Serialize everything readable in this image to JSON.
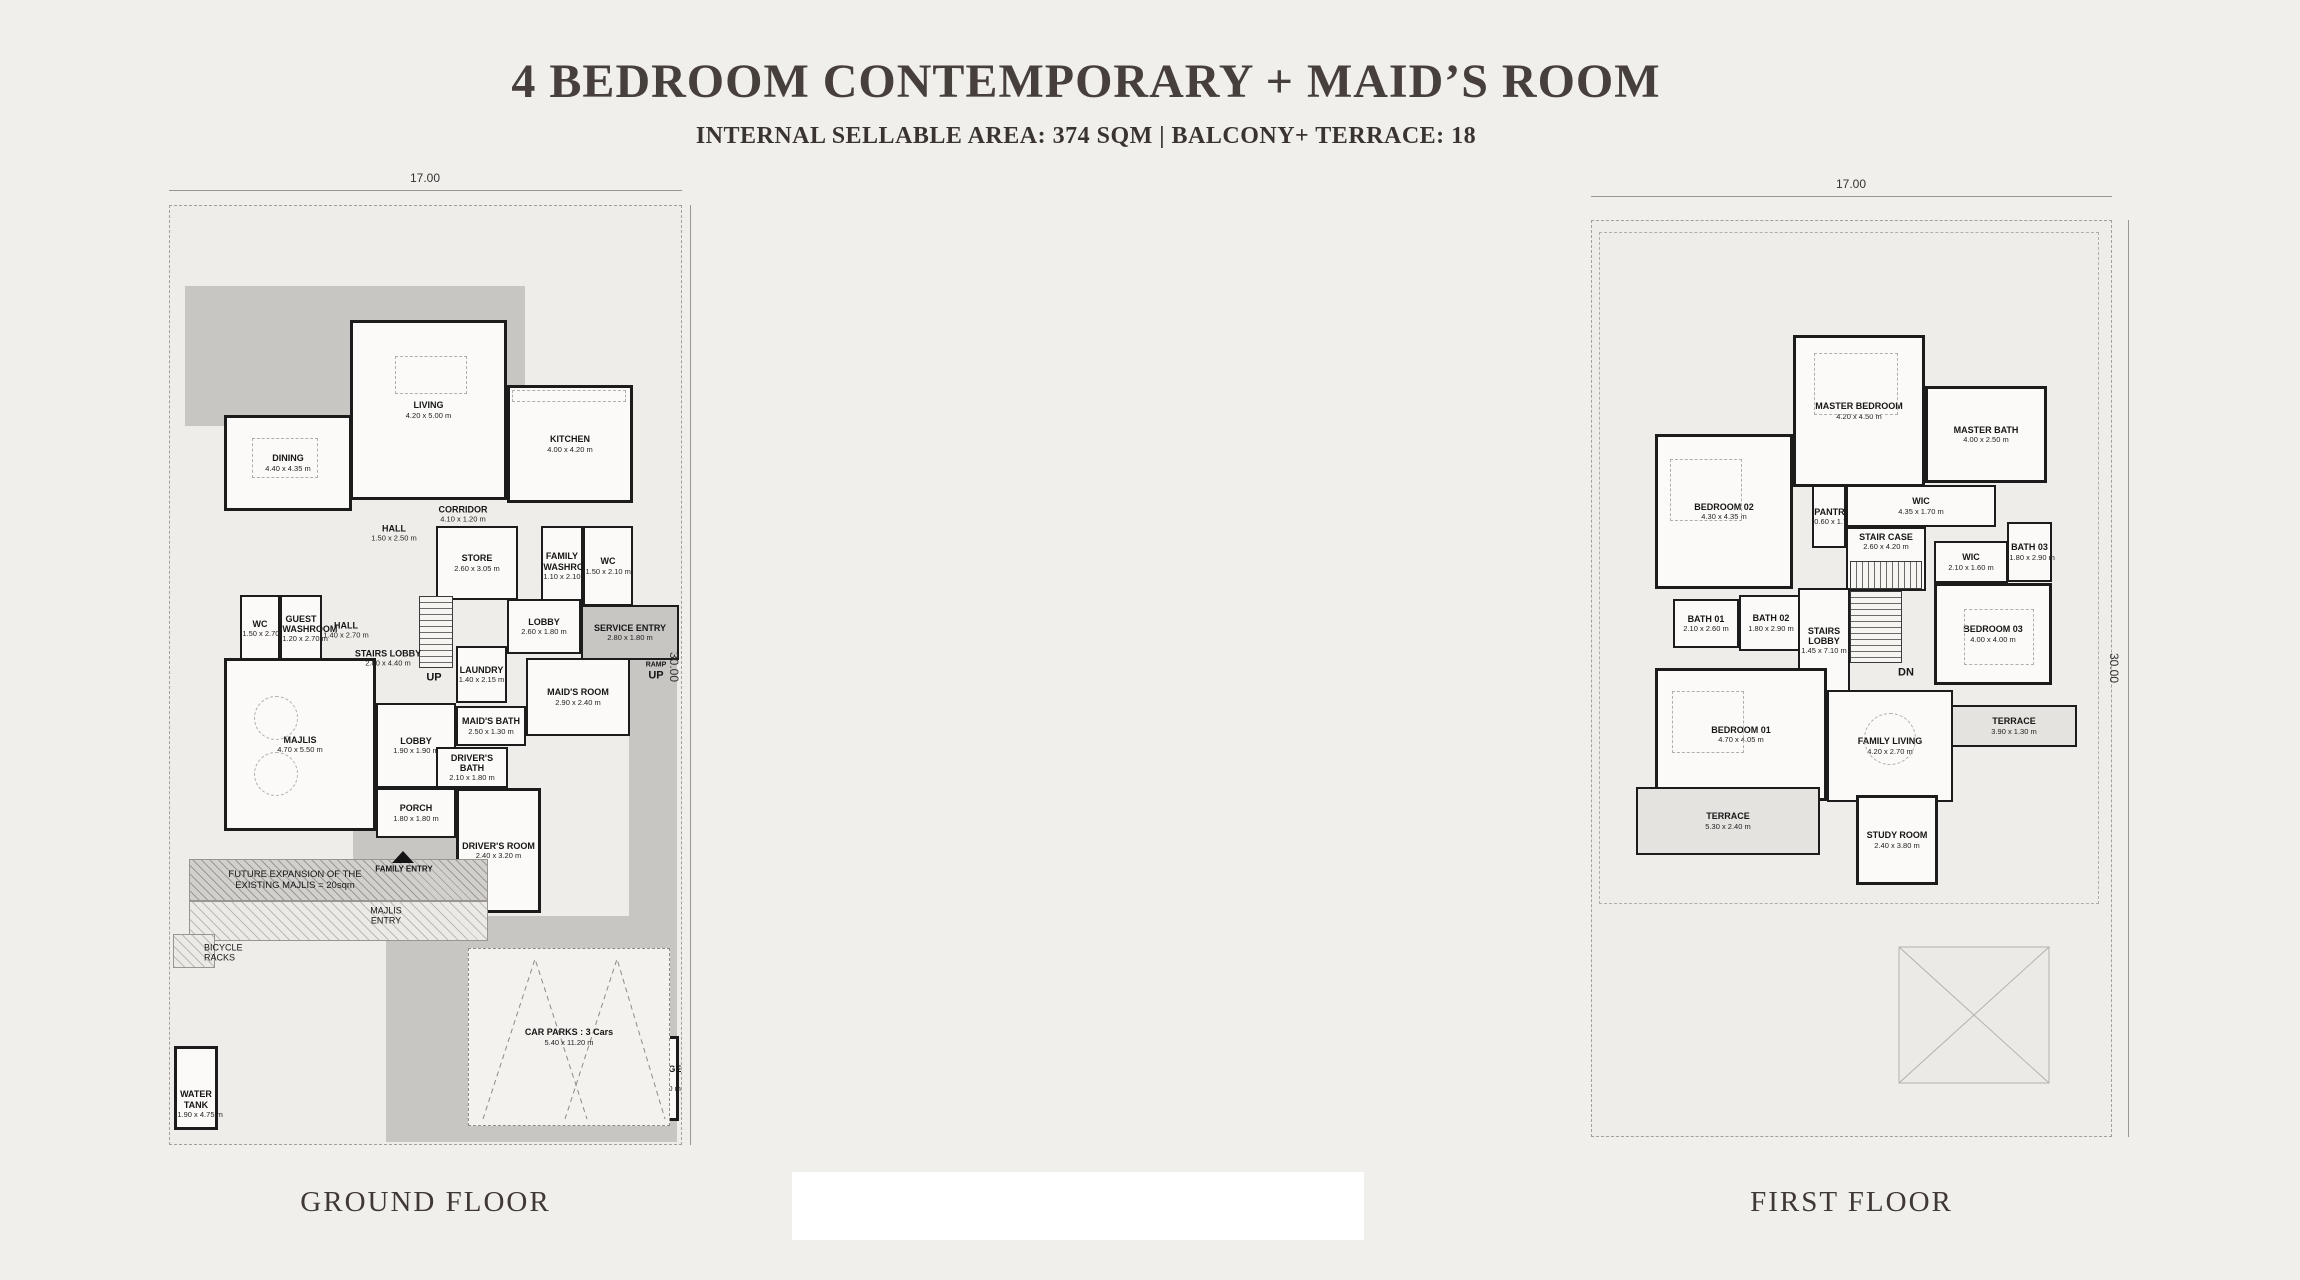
{
  "page": {
    "title": "4 BEDROOM CONTEMPORARY + MAID’S ROOM",
    "subtitle": "INTERNAL SELLABLE AREA: 374 SQM | BALCONY+ TERRACE: 18"
  },
  "colors": {
    "paper": "#f1efeb",
    "paving": "#c7c6c3",
    "wall": "#1c1c1c",
    "ink": "#161616",
    "title": "#473f3b"
  },
  "ground": {
    "label": "GROUND FLOOR",
    "dim_top": "17.00",
    "dim_side": "30.00",
    "rooms": {
      "dining": {
        "name": "DINING",
        "size": "4.40 x 4.35 m"
      },
      "living": {
        "name": "LIVING",
        "size": "4.20 x 5.00 m"
      },
      "kitchen": {
        "name": "KITCHEN",
        "size": "4.00 x 4.20 m"
      },
      "hall_upper": {
        "name": "HALL",
        "size": "1.50 x 2.50 m"
      },
      "corridor": {
        "name": "CORRIDOR",
        "size": "4.10 x 1.20 m"
      },
      "store": {
        "name": "STORE",
        "size": "2.60 x 3.05 m"
      },
      "family_washroom": {
        "name": "FAMILY WASHROOM",
        "size": "1.10 x 2.10 m"
      },
      "wc_upper": {
        "name": "WC",
        "size": "1.50 x 2.10 m"
      },
      "wc_left": {
        "name": "WC",
        "size": "1.50 x 2.70 m"
      },
      "guest_washroom": {
        "name": "GUEST WASHROOM",
        "size": "1.20 x 2.70 m"
      },
      "hall_mid": {
        "name": "HALL",
        "size": "1.40 x 2.70 m"
      },
      "stairs_lobby": {
        "name": "STAIRS LOBBY",
        "size": "2.80 x 4.40 m"
      },
      "lobby_upper": {
        "name": "LOBBY",
        "size": "2.60 x 1.80 m"
      },
      "service_entry": {
        "name": "SERVICE ENTRY",
        "size": "2.80 x 1.80 m"
      },
      "laundry": {
        "name": "LAUNDRY",
        "size": "1.40 x 2.15 m"
      },
      "majlis": {
        "name": "MAJLIS",
        "size": "4.70 x 5.50 m"
      },
      "maids_room": {
        "name": "MAID'S ROOM",
        "size": "2.90 x 2.40 m"
      },
      "maids_bath": {
        "name": "MAID'S BATH",
        "size": "2.50 x 1.30 m"
      },
      "lobby_lower": {
        "name": "LOBBY",
        "size": "1.90 x 1.90 m"
      },
      "drivers_bath": {
        "name": "DRIVER'S BATH",
        "size": "2.10 x 1.80 m"
      },
      "porch": {
        "name": "PORCH",
        "size": "1.80 x 1.80 m"
      },
      "drivers_room": {
        "name": "DRIVER'S ROOM",
        "size": "2.40 x 3.20 m"
      },
      "car_parks": {
        "name": "CAR PARKS : 3 Cars",
        "size": "5.40 x 11.20 m"
      },
      "water_tank": {
        "name": "WATER TANK",
        "size": "1.90 x 4.75 m"
      },
      "garbage_room": {
        "name": "GARBAGE ROOM",
        "size": "1.50 x 3.00 m"
      }
    },
    "annotations": {
      "up": "UP",
      "ramp": "RAMP",
      "ramp_up": "UP",
      "family_entry": "FAMILY ENTRY",
      "majlis_entry": "MAJLIS ENTRY",
      "bicycle_racks": "BICYCLE RACKS",
      "future_expansion": "FUTURE EXPANSION OF THE EXISTING MAJLIS = 20sqm"
    }
  },
  "first": {
    "label": "FIRST FLOOR",
    "dim_top": "17.00",
    "dim_side": "30.00",
    "rooms": {
      "master_bedroom": {
        "name": "MASTER BEDROOM",
        "size": "4.20 x 4.50 m"
      },
      "master_bath": {
        "name": "MASTER BATH",
        "size": "4.00 x 2.50 m"
      },
      "bedroom_02": {
        "name": "BEDROOM 02",
        "size": "4.30 x 4.35 m"
      },
      "pantry": {
        "name": "PANTRY",
        "size": "0.60 x 1.70 m"
      },
      "wic_long": {
        "name": "WIC",
        "size": "4.35 x 1.70 m"
      },
      "stair_case": {
        "name": "STAIR CASE",
        "size": "2.60 x 4.20 m"
      },
      "wic_small": {
        "name": "WIC",
        "size": "2.10 x 1.60 m"
      },
      "bath_03": {
        "name": "BATH 03",
        "size": "1.80 x 2.90 m"
      },
      "bedroom_03": {
        "name": "BEDROOM 03",
        "size": "4.00 x 4.00 m"
      },
      "bath_01": {
        "name": "BATH 01",
        "size": "2.10 x 2.60 m"
      },
      "bath_02": {
        "name": "BATH 02",
        "size": "1.80 x 2.90 m"
      },
      "stairs_lobby": {
        "name": "STAIRS LOBBY",
        "size": "1.45 x 7.10 m"
      },
      "bedroom_01": {
        "name": "BEDROOM 01",
        "size": "4.70 x 4.05 m"
      },
      "family_living": {
        "name": "FAMILY LIVING",
        "size": "4.20 x 2.70 m"
      },
      "terrace_right": {
        "name": "TERRACE",
        "size": "3.90 x 1.30 m"
      },
      "terrace_bottom": {
        "name": "TERRACE",
        "size": "5.30 x 2.40 m"
      },
      "study_room": {
        "name": "STUDY ROOM",
        "size": "2.40 x 3.80 m"
      }
    },
    "annotations": {
      "dn": "DN"
    }
  }
}
